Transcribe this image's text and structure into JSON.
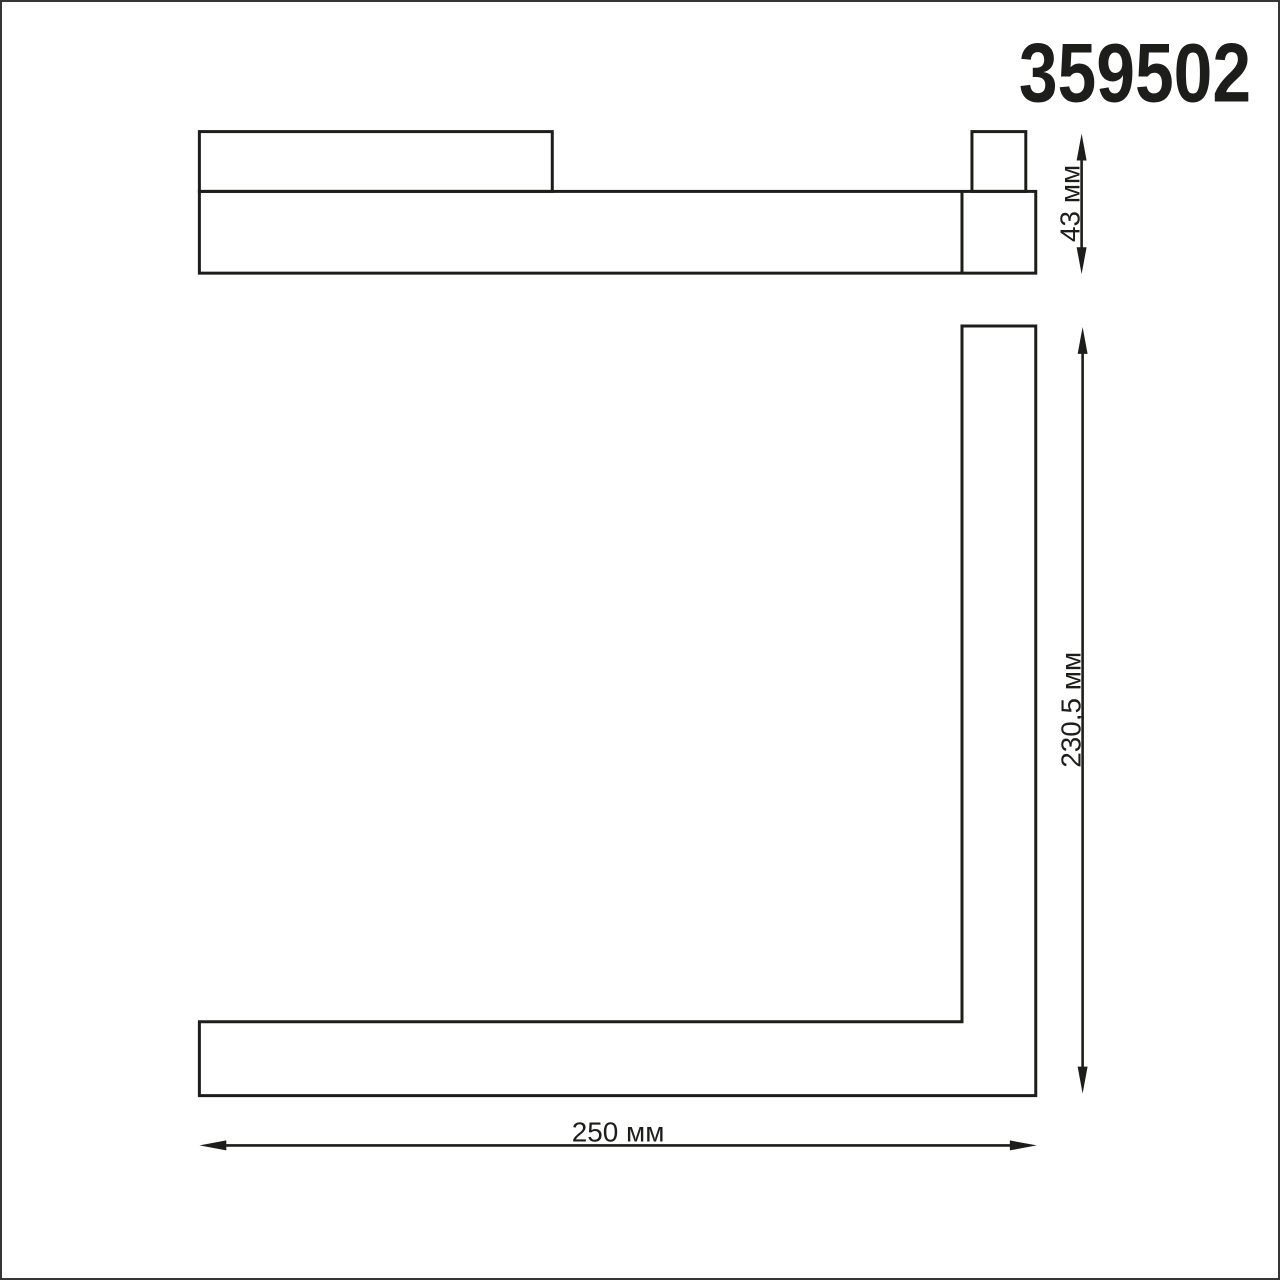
{
  "product": {
    "code": "359502"
  },
  "drawing": {
    "background_color": "#ffffff",
    "stroke_color": "#1d1d1b",
    "border_color": "#353535"
  },
  "dims": {
    "side_height": "43 мм",
    "front_height": "230,5 мм",
    "front_width": "250 мм"
  }
}
